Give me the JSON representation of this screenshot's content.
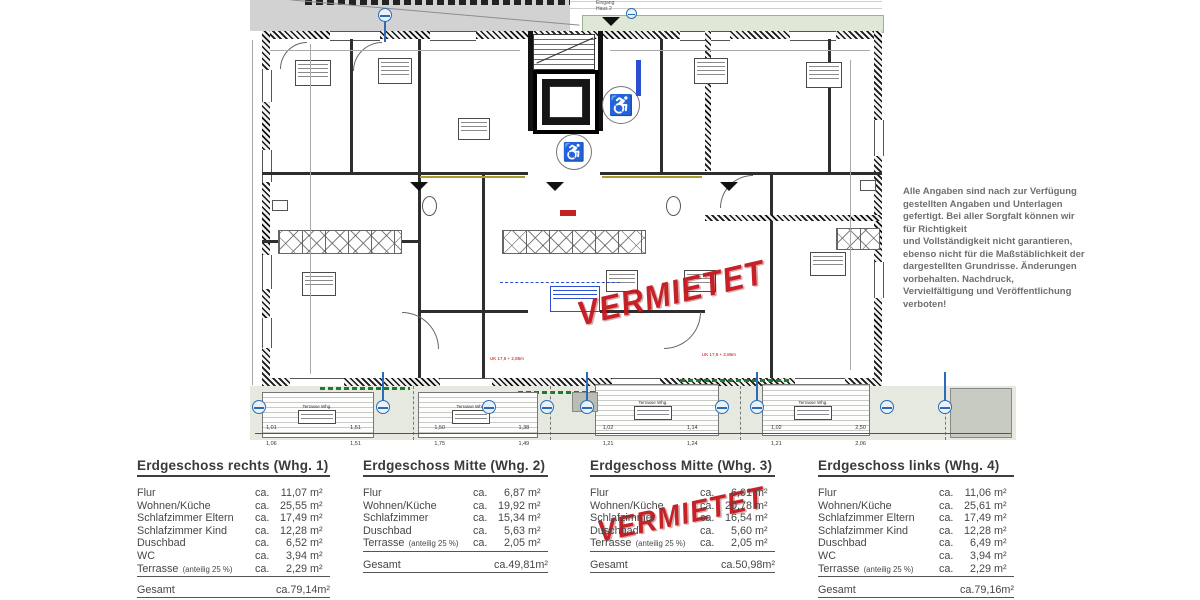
{
  "stamp": {
    "text": "VERMIETET",
    "color": "#c5161d"
  },
  "disclaimer": {
    "text": "Alle Angaben sind nach zur Verfügung\ngestellten Angaben und Unterlagen\ngefertigt. Bei aller Sorgfalt können wir\nfür Richtigkeit\nund Vollständigkeit nicht garantieren,\nebenso nicht für die Maßstäblichkeit der\ndargestellten Grundrisse. Änderungen\nvorbehalten. Nachdruck,\nVervielfältigung und Veröffentlichung\nverboten!"
  },
  "units": {
    "ca": "ca.",
    "sqm": "m²"
  },
  "plan": {
    "entrance_label": "Eingang\nHaus 2",
    "terrace_box_label": "Terrasse Whg.",
    "red_note": "UK 17,5 + 2,86m",
    "wheelchair_symbol": "♿",
    "dims_row1": [
      "1,01",
      "1,51",
      "1,50",
      "1,38",
      "1,02",
      "1,14",
      "1,02",
      "2,50"
    ],
    "dims_row2": [
      "1,06",
      "1,51",
      "1,75",
      "1,49",
      "1,21",
      "1,24",
      "1,21",
      "2,06"
    ]
  },
  "tables": [
    {
      "title": "Erdgeschoss rechts (Whg. 1)",
      "rows": [
        {
          "label": "Flur",
          "value": "11,07"
        },
        {
          "label": "Wohnen/Küche",
          "value": "25,55"
        },
        {
          "label": "Schlafzimmer Eltern",
          "value": "17,49"
        },
        {
          "label": "Schlafzimmer Kind",
          "value": "12,28"
        },
        {
          "label": "Duschbad",
          "value": "6,52"
        },
        {
          "label": "WC",
          "value": "3,94"
        },
        {
          "label": "Terrasse",
          "small": "(anteilig 25 %)",
          "value": "2,29",
          "underline": true
        }
      ],
      "total_label": "Gesamt",
      "total_value": "79,14"
    },
    {
      "title": "Erdgeschoss Mitte (Whg. 2)",
      "rows": [
        {
          "label": "Flur",
          "value": "6,87"
        },
        {
          "label": "Wohnen/Küche",
          "value": "19,92"
        },
        {
          "label": "Schlafzimmer",
          "value": "15,34"
        },
        {
          "label": "Duschbad",
          "value": "5,63"
        },
        {
          "label": "Terrasse",
          "small": "(anteilig 25 %)",
          "value": "2,05",
          "underline": true
        }
      ],
      "total_label": "Gesamt",
      "total_value": "49,81"
    },
    {
      "title": "Erdgeschoss Mitte (Whg. 3)",
      "rows": [
        {
          "label": "Flur",
          "value": "6,01"
        },
        {
          "label": "Wohnen/Küche",
          "value": "20,78"
        },
        {
          "label": "Schlafzimmer",
          "value": "16,54"
        },
        {
          "label": "Duschbad",
          "value": "5,60"
        },
        {
          "label": "Terrasse",
          "small": "(anteilig 25 %)",
          "value": "2,05",
          "underline": true
        }
      ],
      "total_label": "Gesamt",
      "total_value": "50,98"
    },
    {
      "title": "Erdgeschoss links (Whg. 4)",
      "rows": [
        {
          "label": "Flur",
          "value": "11,06"
        },
        {
          "label": "Wohnen/Küche",
          "value": "25,61"
        },
        {
          "label": "Schlafzimmer Eltern",
          "value": "17,49"
        },
        {
          "label": "Schlafzimmer Kind",
          "value": "12,28"
        },
        {
          "label": "Duschbad",
          "value": "6,49"
        },
        {
          "label": "WC",
          "value": "3,94"
        },
        {
          "label": "Terrasse",
          "small": "(anteilig 25 %)",
          "value": "2,29",
          "underline": true
        }
      ],
      "total_label": "Gesamt",
      "total_value": "79,16"
    }
  ]
}
